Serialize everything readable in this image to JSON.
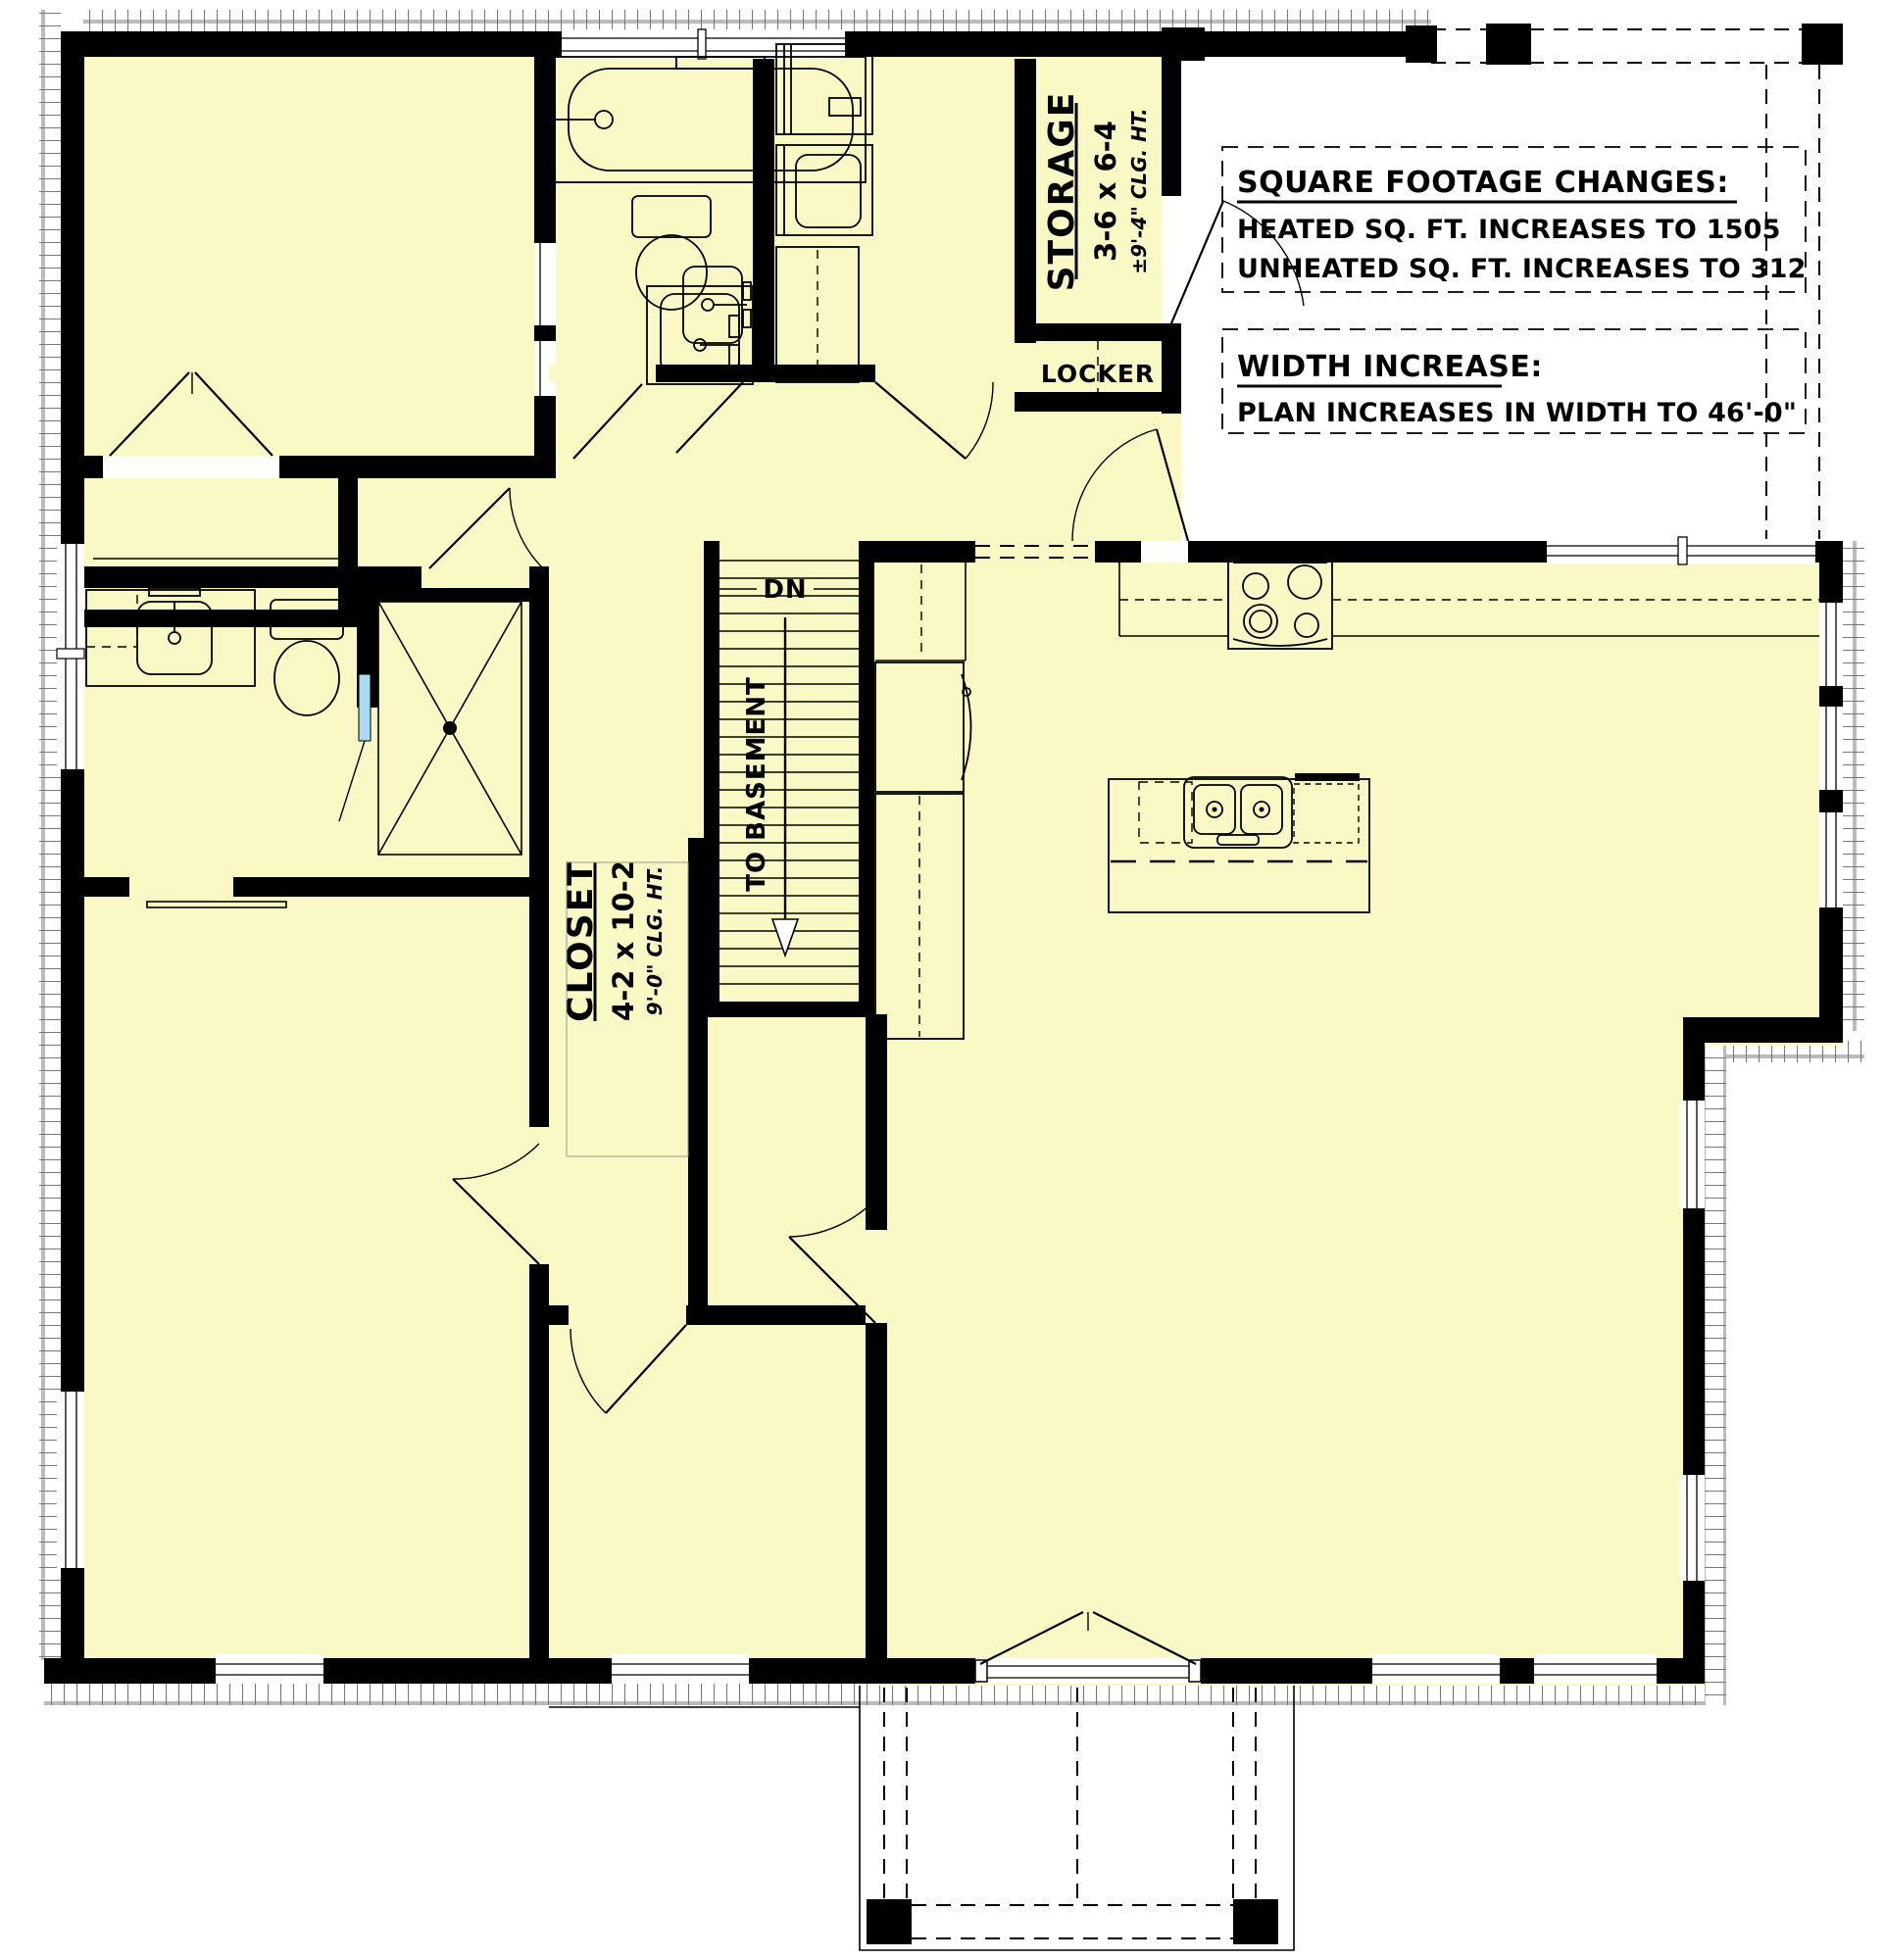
{
  "rooms": {
    "storage": {
      "name": "STORAGE",
      "dims": "3-6 x 6-4",
      "ceiling": "±9'-4\" CLG. HT."
    },
    "closet": {
      "name": "CLOSET",
      "dims": "4-2 x 10-2",
      "ceiling": "9'-0\" CLG. HT."
    },
    "locker": {
      "name": "LOCKER"
    }
  },
  "stairs": {
    "down": "DN",
    "destination": "TO BASEMENT"
  },
  "notes": {
    "square_footage": {
      "title": "SQUARE FOOTAGE CHANGES:",
      "lines": [
        "HEATED SQ. FT. INCREASES TO 1505",
        "UNHEATED SQ. FT. INCREASES TO 312"
      ]
    },
    "width_increase": {
      "title": "WIDTH INCREASE:",
      "lines": [
        "PLAN INCREASES IN WIDTH TO 46'-0\""
      ]
    }
  },
  "colors": {
    "floor": "#FAF8C4",
    "wall": "#000000",
    "background": "#FFFFFF",
    "pocket_door": "#A9DCEE"
  }
}
